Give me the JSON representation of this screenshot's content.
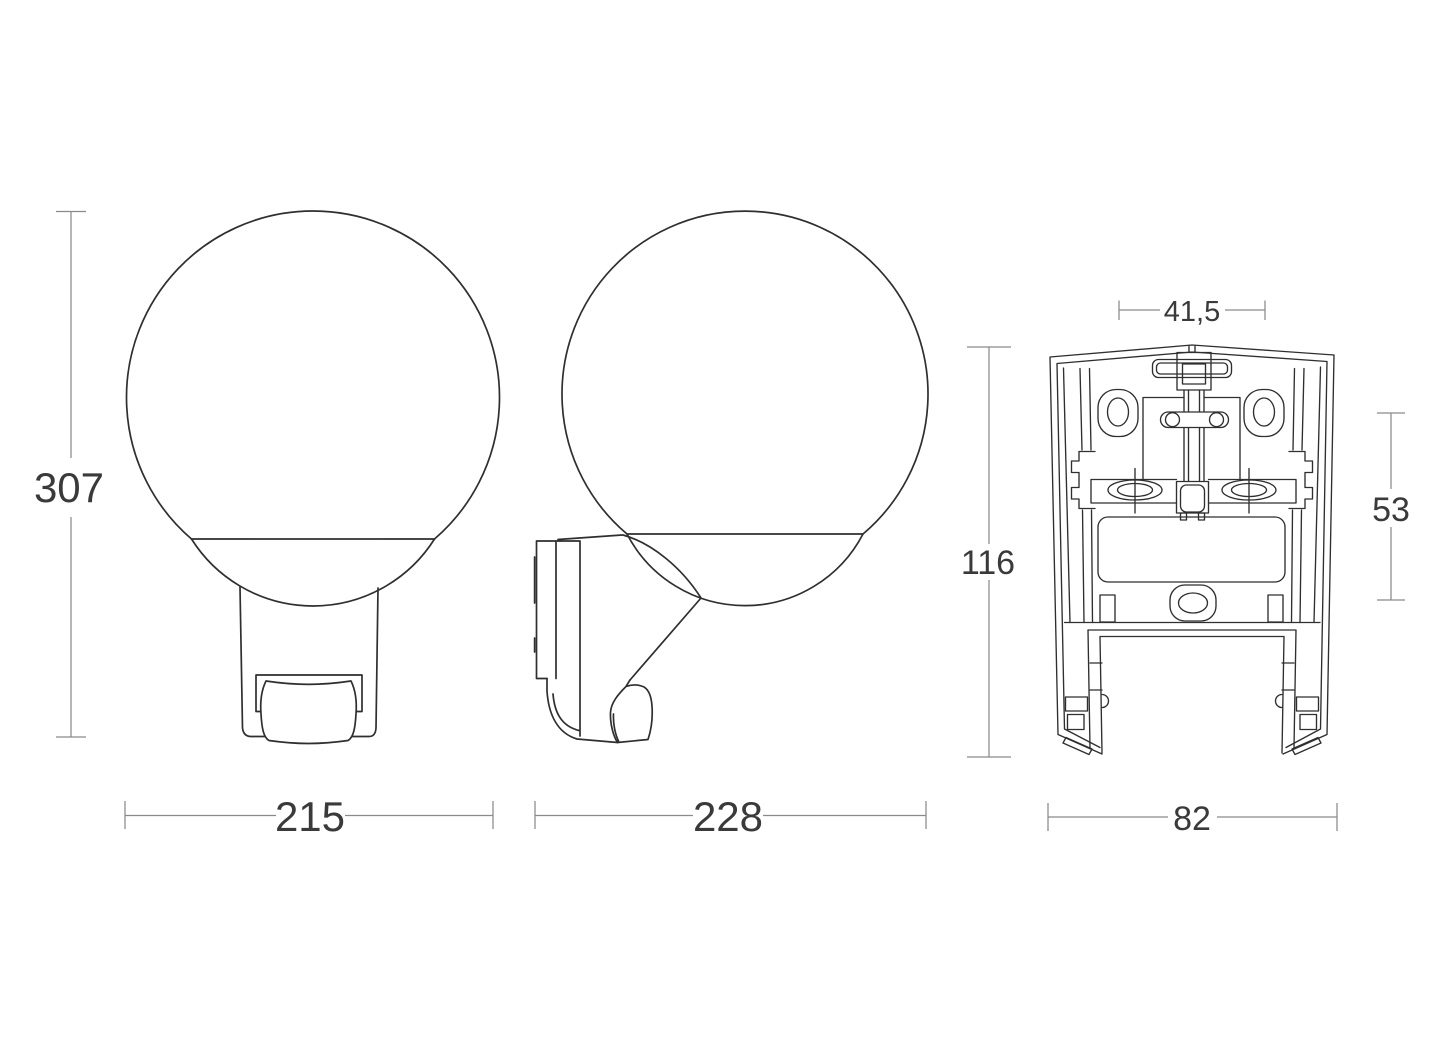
{
  "drawing": {
    "views": {
      "front": {
        "dim_height": "307",
        "dim_width": "215"
      },
      "side": {
        "dim_width": "228"
      },
      "rear": {
        "dim_hole_spacing": "41,5",
        "dim_height": "116",
        "dim_side_offset": "53",
        "dim_width": "82"
      }
    }
  },
  "colors": {
    "background": "#ffffff",
    "outline": "#2f2f2f",
    "dim_line": "#8a8a8a",
    "dim_text": "#3a3a3a"
  }
}
